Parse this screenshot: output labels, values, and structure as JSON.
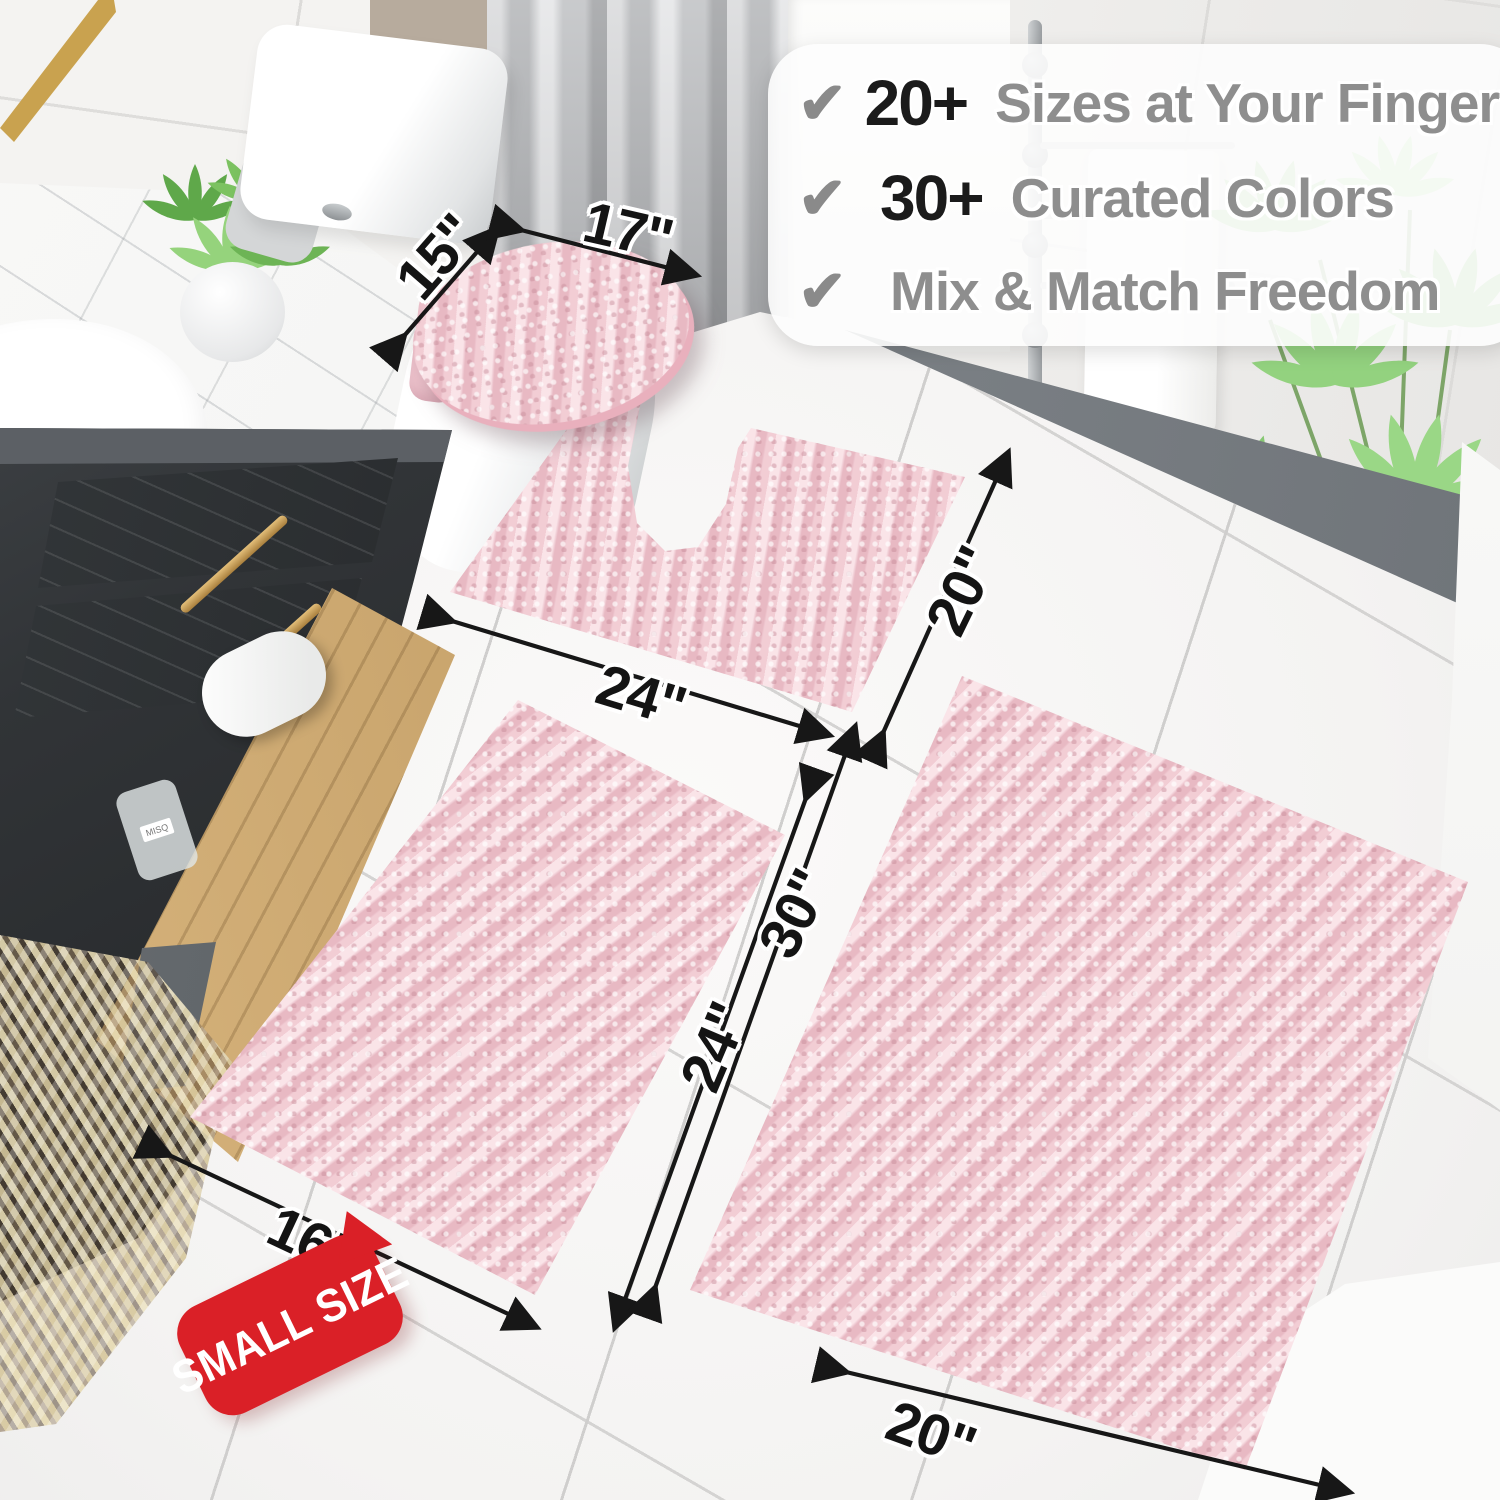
{
  "features": {
    "rows": [
      {
        "icon": "✔",
        "count": "20+",
        "label": "Sizes at Your Fingertips"
      },
      {
        "icon": "✔",
        "count": "30+",
        "label": "Curated Colors"
      },
      {
        "icon": "✔",
        "count": "",
        "label": "Mix & Match Freedom"
      }
    ]
  },
  "dimensions": {
    "lid_width": "15\"",
    "lid_length": "17\"",
    "contour_width": "24\"",
    "contour_depth": "20\"",
    "small_rug_width": "16\"",
    "small_rug_length": "24\"",
    "large_rug_length": "30\"",
    "large_rug_width": "20\""
  },
  "badge": {
    "label": "SMALL SIZE"
  },
  "vanity": {
    "bottle_label": "MISQ"
  },
  "colors": {
    "rug_pink": "#f1cbd3",
    "rug_base_pink": "#edb6c3",
    "badge_red": "#da2027",
    "check_gray": "#8a8a8a",
    "count_black": "#1b1b1b",
    "feature_text_gray": "#8e8e8e",
    "gold": "#c69c50"
  }
}
